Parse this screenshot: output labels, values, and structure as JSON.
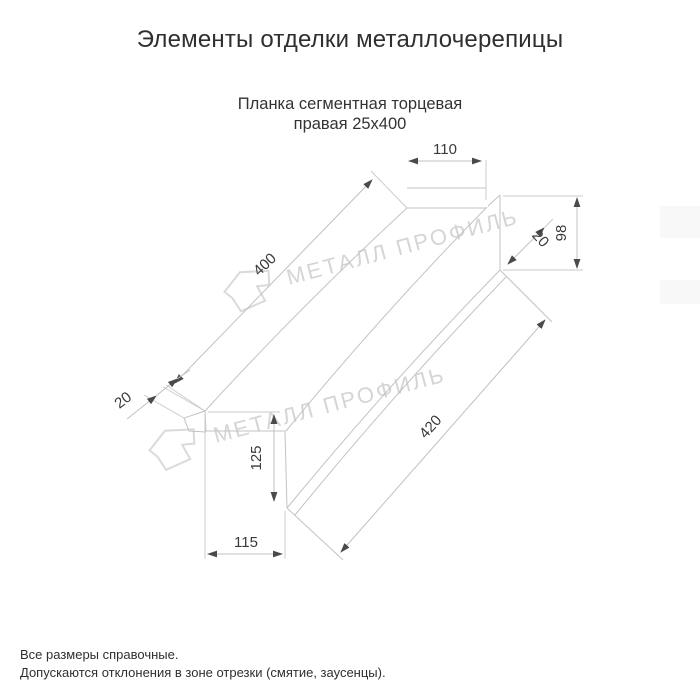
{
  "header": {
    "title": "Элементы отделки металлочерепицы"
  },
  "drawing": {
    "subtitle_line1": "Планка сегментная торцевая",
    "subtitle_line2": "правая 25х400",
    "watermark_text": "МЕТАЛЛ ПРОФИЛЬ",
    "watermark_logo": "metall-profil-arrow-logo",
    "dimensions": {
      "top_flange_width": "110",
      "right_end_height": "98",
      "right_hem": "20",
      "top_length": "400",
      "bottom_length": "420",
      "left_end_height": "125",
      "bottom_flange_width": "115",
      "left_hem": "20"
    }
  },
  "footer": {
    "note1": "Все размеры справочные.",
    "note2": "Допускаются отклонения в зоне отрезки (смятие, заусенцы)."
  },
  "colors": {
    "background": "#ffffff",
    "drawing_lines": "#c3c3c3",
    "dimension_text": "#3a3a3a",
    "arrowheads": "#4a4a4a",
    "watermark": "#d5d5d5",
    "title_text": "#2f2f2f"
  }
}
